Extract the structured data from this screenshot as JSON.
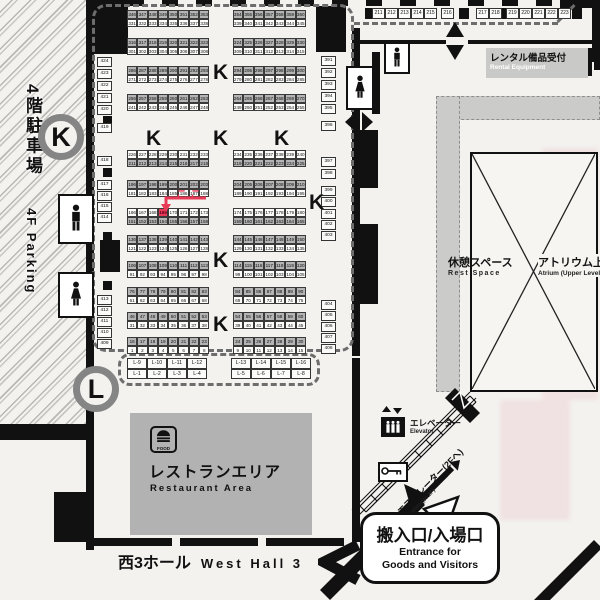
{
  "map": {
    "parking": {
      "jp": "4階駐車場",
      "en": "4F Parking"
    },
    "zone_badges": {
      "k": "K",
      "l": "L"
    },
    "booths": {
      "k_letter": "K",
      "k_positions": [
        [
          213,
          62
        ],
        [
          146,
          128
        ],
        [
          213,
          128
        ],
        [
          274,
          128
        ],
        [
          309,
          192
        ],
        [
          213,
          250
        ],
        [
          213,
          314
        ]
      ],
      "highlight": {
        "number": 169,
        "label": "ここ"
      },
      "bands": [
        {
          "y": 10,
          "shade": "top",
          "lt": [
            346,
            347,
            348,
            349,
            350,
            351,
            352,
            353
          ],
          "rt": [
            354,
            355,
            356,
            357,
            358,
            359,
            360
          ],
          "lb": [
            331,
            332,
            333,
            334,
            335,
            336,
            337,
            338
          ],
          "rb": [
            339,
            340,
            341,
            342,
            343,
            344,
            345
          ]
        },
        {
          "y": 38,
          "shade": "top",
          "lt": [
            316,
            317,
            318,
            319,
            320,
            321,
            322,
            323
          ],
          "rt": [
            324,
            325,
            326,
            327,
            328,
            329,
            330
          ],
          "lb": [
            301,
            302,
            303,
            304,
            305,
            306,
            307,
            308
          ],
          "rb": [
            309,
            310,
            311,
            312,
            313,
            314,
            315
          ]
        },
        {
          "y": 66,
          "shade": "top",
          "lt": [
            286,
            287,
            288,
            289,
            290,
            291,
            292,
            293
          ],
          "rt": [
            294,
            295,
            296,
            297,
            298,
            299,
            300
          ],
          "lb": [
            271,
            272,
            273,
            274,
            275,
            276,
            277,
            278
          ],
          "rb": [
            279,
            280,
            281,
            282,
            283,
            284,
            285
          ]
        },
        {
          "y": 94,
          "shade": "top",
          "lt": [
            256,
            257,
            258,
            259,
            260,
            261,
            262,
            263
          ],
          "rt": [
            264,
            265,
            266,
            267,
            268,
            269,
            270
          ],
          "lb": [
            241,
            242,
            243,
            244,
            245,
            246,
            247,
            248
          ],
          "rb": [
            249,
            250,
            251,
            252,
            253,
            254,
            255
          ]
        },
        {
          "y": 150,
          "shade": "bottom",
          "lt": [
            226,
            227,
            228,
            229,
            230,
            231,
            232,
            233
          ],
          "rt": [
            234,
            235,
            236,
            237,
            238,
            239,
            240
          ],
          "lb": [
            211,
            212,
            213,
            214,
            215,
            216,
            217,
            218
          ],
          "rb": [
            219,
            220,
            221,
            222,
            223,
            224,
            225
          ]
        },
        {
          "y": 180,
          "shade": "top",
          "lt": [
            196,
            197,
            198,
            199,
            200,
            201,
            202,
            203
          ],
          "rt": [
            204,
            205,
            206,
            207,
            208,
            209,
            210
          ],
          "lb": [
            181,
            182,
            183,
            184,
            185,
            186,
            187,
            188
          ],
          "rb": [
            189,
            190,
            191,
            192,
            193,
            194,
            195
          ]
        },
        {
          "y": 208,
          "shade": "bottom",
          "lt": [
            166,
            167,
            168,
            169,
            170,
            171,
            172,
            173
          ],
          "rt": [
            174,
            175,
            176,
            177,
            178,
            179,
            180
          ],
          "lb": [
            151,
            152,
            153,
            154,
            155,
            156,
            157,
            158
          ],
          "rb": [
            159,
            160,
            161,
            162,
            163,
            164,
            165
          ]
        },
        {
          "y": 235,
          "shade": "top",
          "lt": [
            136,
            137,
            138,
            139,
            140,
            141,
            142,
            143
          ],
          "rt": [
            144,
            145,
            146,
            147,
            148,
            149,
            150
          ],
          "lb": [
            121,
            122,
            123,
            124,
            125,
            126,
            127,
            128
          ],
          "rb": [
            129,
            130,
            131,
            132,
            133,
            134,
            135
          ]
        },
        {
          "y": 261,
          "shade": "top",
          "lt": [
            106,
            107,
            108,
            109,
            110,
            111,
            112,
            113
          ],
          "rt": [
            114,
            115,
            116,
            117,
            118,
            119,
            120
          ],
          "lb": [
            91,
            92,
            93,
            94,
            95,
            96,
            97,
            98
          ],
          "rb": [
            99,
            100,
            101,
            102,
            103,
            104,
            105
          ]
        },
        {
          "y": 287,
          "shade": "top",
          "lt": [
            76,
            77,
            78,
            79,
            80,
            81,
            82,
            83
          ],
          "rt": [
            84,
            85,
            86,
            87,
            88,
            89,
            90
          ],
          "lb": [
            61,
            62,
            63,
            64,
            65,
            66,
            67,
            68
          ],
          "rb": [
            69,
            70,
            71,
            72,
            73,
            74,
            75
          ]
        },
        {
          "y": 312,
          "shade": "top",
          "lt": [
            46,
            47,
            48,
            49,
            50,
            51,
            52,
            53
          ],
          "rt": [
            54,
            55,
            56,
            57,
            58,
            59,
            60
          ],
          "lb": [
            31,
            32,
            33,
            34,
            35,
            36,
            37,
            38
          ],
          "rb": [
            39,
            40,
            41,
            42,
            43,
            44,
            45
          ]
        },
        {
          "y": 337,
          "shade": "top",
          "lt": [
            16,
            17,
            18,
            19,
            20,
            21,
            22,
            23
          ],
          "rt": [
            24,
            25,
            26,
            27,
            28,
            29,
            30
          ],
          "lb": [
            1,
            2,
            3,
            4,
            5,
            6,
            7,
            8
          ],
          "rb": [
            9,
            10,
            11,
            12,
            13,
            14,
            15
          ]
        }
      ],
      "wall_left": [
        [
          424,
          57
        ],
        [
          423,
          69
        ],
        [
          422,
          81
        ],
        [
          421,
          93
        ],
        [
          420,
          105
        ],
        [
          419,
          123
        ],
        [
          418,
          156
        ],
        [
          417,
          180
        ],
        [
          416,
          191
        ],
        [
          415,
          202
        ],
        [
          414,
          213
        ],
        [
          413,
          295
        ],
        [
          412,
          306
        ],
        [
          411,
          317
        ],
        [
          410,
          328
        ],
        [
          409,
          339
        ]
      ],
      "wall_right": [
        [
          391,
          56
        ],
        [
          392,
          68
        ],
        [
          393,
          80
        ],
        [
          394,
          92
        ],
        [
          395,
          104
        ],
        [
          396,
          121
        ],
        [
          397,
          157
        ],
        [
          398,
          169
        ],
        [
          399,
          186
        ],
        [
          400,
          197
        ],
        [
          401,
          209
        ],
        [
          402,
          220
        ],
        [
          403,
          231
        ],
        [
          404,
          300
        ],
        [
          405,
          311
        ],
        [
          406,
          322
        ],
        [
          407,
          333
        ],
        [
          408,
          344
        ]
      ],
      "wall_top_groups": [
        {
          "x": 372,
          "nums": [
            211,
            212,
            213,
            214,
            215
          ]
        },
        {
          "x": 441,
          "nums": [
            216
          ]
        },
        {
          "x": 476,
          "nums": [
            217,
            218
          ]
        },
        {
          "x": 506,
          "nums": [
            219,
            220,
            221,
            222,
            223
          ]
        }
      ],
      "l_row": {
        "left_top": [
          "L-9",
          "L-10",
          "L-11",
          "L-12"
        ],
        "left_bottom": [
          "L-1",
          "L-2",
          "L-3",
          "L-4"
        ],
        "right_top": [
          "L-13",
          "L-14",
          "L-15",
          "L-16"
        ],
        "right_bottom": [
          "L-5",
          "L-6",
          "L-7",
          "L-8"
        ]
      }
    },
    "restaurant": {
      "jp": "レストランエリア",
      "en": "Restaurant Area",
      "icon": "FOOD"
    },
    "hall": {
      "jp": "西3ホール",
      "en": "West Hall 3"
    },
    "rental": {
      "jp": "レンタル備品受付",
      "en": "Rental Equipment"
    },
    "rest_space": {
      "jp": "休憩スペース",
      "en": "Rest Space"
    },
    "atrium": {
      "jp": "アトリウム上部",
      "en": "Atrium (Upper Level)"
    },
    "elevator": {
      "jp": "エレベーター",
      "en": "Elevator"
    },
    "escalator": {
      "jp": "エスカレーター(2Fへ)",
      "en": "Escalator(to 2F)"
    },
    "entrance": {
      "jp": "搬入口/入場口",
      "en1": "Entrance for",
      "en2": "Goods and Visitors"
    },
    "colors": {
      "red": "#e83a57",
      "shade": "#b4b4b4",
      "wall": "#111111",
      "band_grey": "#cbcbca",
      "area_grey": "#b2b2b2"
    }
  }
}
